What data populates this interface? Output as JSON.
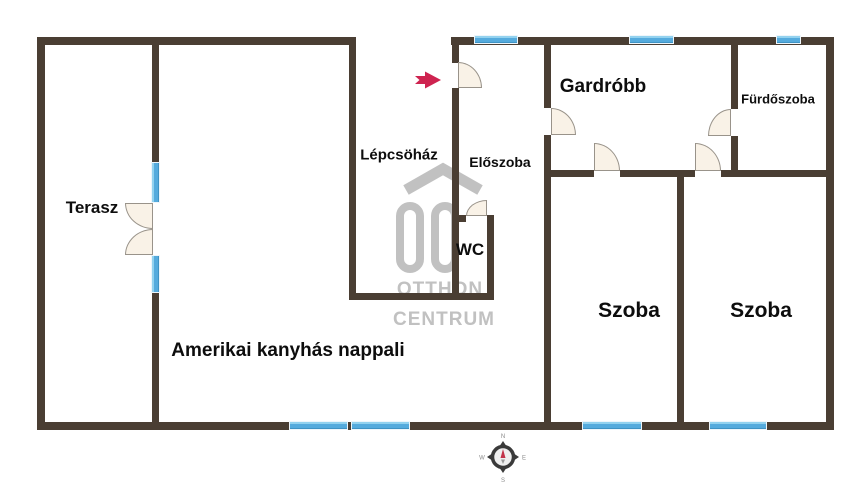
{
  "colors": {
    "wall": "#4a3e33",
    "window_blue": "#55abdd",
    "window_blue_light": "#93d2ef",
    "door_fill": "#f9f2e7",
    "door_border": "#99938a",
    "entrance_arrow_red": "#ce2350",
    "watermark_gray": "#c1c1c1",
    "label_text": "#0d0d0d"
  },
  "rooms": [
    {
      "id": "terasz",
      "label": "Terasz",
      "cx": 92,
      "cy": 208,
      "fs": 17
    },
    {
      "id": "lepcsohaz",
      "label": "Lépcsöház",
      "cx": 399,
      "cy": 155,
      "fs": 15
    },
    {
      "id": "eloszoba",
      "label": "Előszoba",
      "cx": 500,
      "cy": 162,
      "fs": 14
    },
    {
      "id": "gardrob",
      "label": "Gardróbb",
      "cx": 603,
      "cy": 87,
      "fs": 19
    },
    {
      "id": "furdoszoba",
      "label": "Fürdőszoba",
      "cx": 778,
      "cy": 99,
      "fs": 13
    },
    {
      "id": "wc",
      "label": "WC",
      "cx": 470,
      "cy": 250,
      "fs": 17
    },
    {
      "id": "szoba-left",
      "label": "Szoba",
      "cx": 629,
      "cy": 311,
      "fs": 21
    },
    {
      "id": "szoba-right",
      "label": "Szoba",
      "cx": 761,
      "cy": 311,
      "fs": 21
    },
    {
      "id": "nappali",
      "label": "Amerikai kanyhás nappali",
      "cx": 288,
      "cy": 351,
      "fs": 19
    }
  ],
  "watermark": {
    "line1": "OTTHON",
    "line2": "CENTRUM"
  },
  "compass": {
    "north": "N",
    "south": "S",
    "east": "E",
    "west": "W"
  },
  "plan": {
    "walls": [
      [
        37,
        37,
        319,
        8
      ],
      [
        37,
        37,
        8,
        393
      ],
      [
        37,
        422,
        797,
        8
      ],
      [
        826,
        37,
        8,
        393
      ],
      [
        451,
        37,
        383,
        8
      ],
      [
        152,
        37,
        7,
        125
      ],
      [
        152,
        293,
        7,
        137
      ],
      [
        349,
        37,
        7,
        263
      ],
      [
        349,
        293,
        145,
        7
      ],
      [
        452,
        37,
        7,
        26
      ],
      [
        452,
        88,
        7,
        205
      ],
      [
        452,
        215,
        14,
        7
      ],
      [
        487,
        215,
        7,
        85
      ],
      [
        544,
        37,
        7,
        71
      ],
      [
        544,
        135,
        7,
        295
      ],
      [
        544,
        170,
        50,
        7
      ],
      [
        620,
        170,
        75,
        7
      ],
      [
        721,
        170,
        113,
        7
      ],
      [
        677,
        170,
        7,
        260
      ],
      [
        731,
        37,
        7,
        72
      ],
      [
        731,
        136,
        7,
        41
      ]
    ],
    "windows": [
      {
        "x": 474,
        "y": 35,
        "w": 44,
        "h": 9,
        "o": "h"
      },
      {
        "x": 629,
        "y": 35,
        "w": 45,
        "h": 9,
        "o": "h"
      },
      {
        "x": 776,
        "y": 35,
        "w": 25,
        "h": 9,
        "o": "h"
      },
      {
        "x": 289,
        "y": 421,
        "w": 59,
        "h": 9,
        "o": "h"
      },
      {
        "x": 351,
        "y": 421,
        "w": 59,
        "h": 9,
        "o": "h"
      },
      {
        "x": 582,
        "y": 421,
        "w": 60,
        "h": 9,
        "o": "h"
      },
      {
        "x": 709,
        "y": 421,
        "w": 58,
        "h": 9,
        "o": "h"
      },
      {
        "x": 151,
        "y": 162,
        "w": 9,
        "h": 41,
        "o": "v"
      },
      {
        "x": 151,
        "y": 255,
        "w": 9,
        "h": 38,
        "o": "v"
      }
    ],
    "doors": [
      {
        "x": 458,
        "y": 62,
        "w": 24,
        "h": 26,
        "corner": "tr"
      },
      {
        "x": 551,
        "y": 108,
        "w": 25,
        "h": 27,
        "corner": "tr"
      },
      {
        "x": 594,
        "y": 143,
        "w": 26,
        "h": 28,
        "corner": "tr"
      },
      {
        "x": 695,
        "y": 143,
        "w": 26,
        "h": 28,
        "corner": "tr"
      },
      {
        "x": 708,
        "y": 109,
        "w": 23,
        "h": 27,
        "corner": "tl"
      },
      {
        "x": 466,
        "y": 200,
        "w": 21,
        "h": 16,
        "corner": "tl"
      },
      {
        "x": 125,
        "y": 203,
        "w": 28,
        "h": 26,
        "corner": "bl"
      },
      {
        "x": 125,
        "y": 229,
        "w": 28,
        "h": 26,
        "corner": "tl"
      }
    ]
  }
}
